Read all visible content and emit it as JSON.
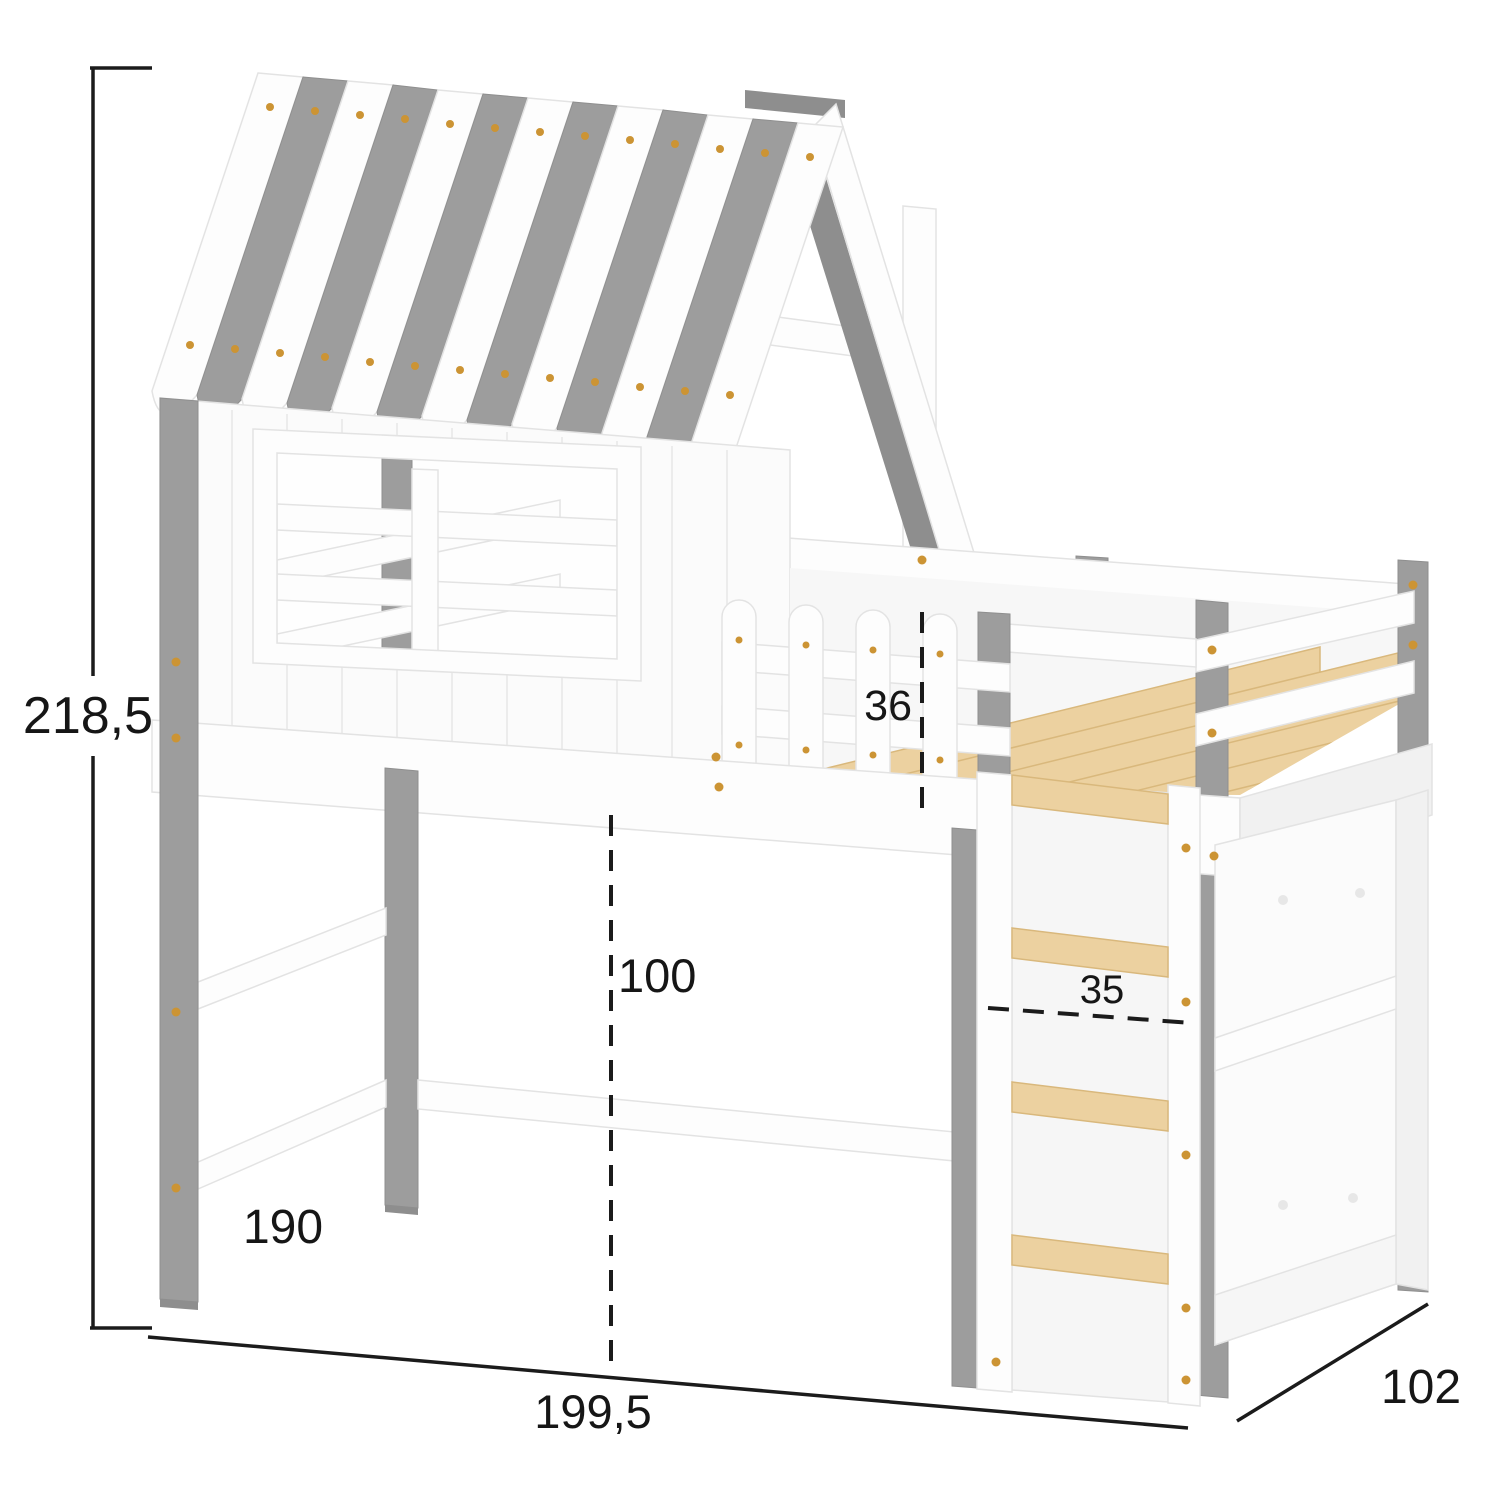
{
  "dimensions": {
    "overall_height": "218,5",
    "leg_height": "190",
    "overall_length": "199,5",
    "depth": "102",
    "underbed_clearance": "100",
    "guardrail_height": "36",
    "ladder_width": "35"
  },
  "colors": {
    "background": "#ffffff",
    "white_part": "#fdfdfd",
    "part_edge": "#e3e3e3",
    "gray_part": "#9d9d9d",
    "gray_dark": "#8e8e8e",
    "wood": "#ecd1a0",
    "wood_edge": "#d9b87c",
    "screw": "#cc9434",
    "dimension_line": "#1b1b1b"
  }
}
